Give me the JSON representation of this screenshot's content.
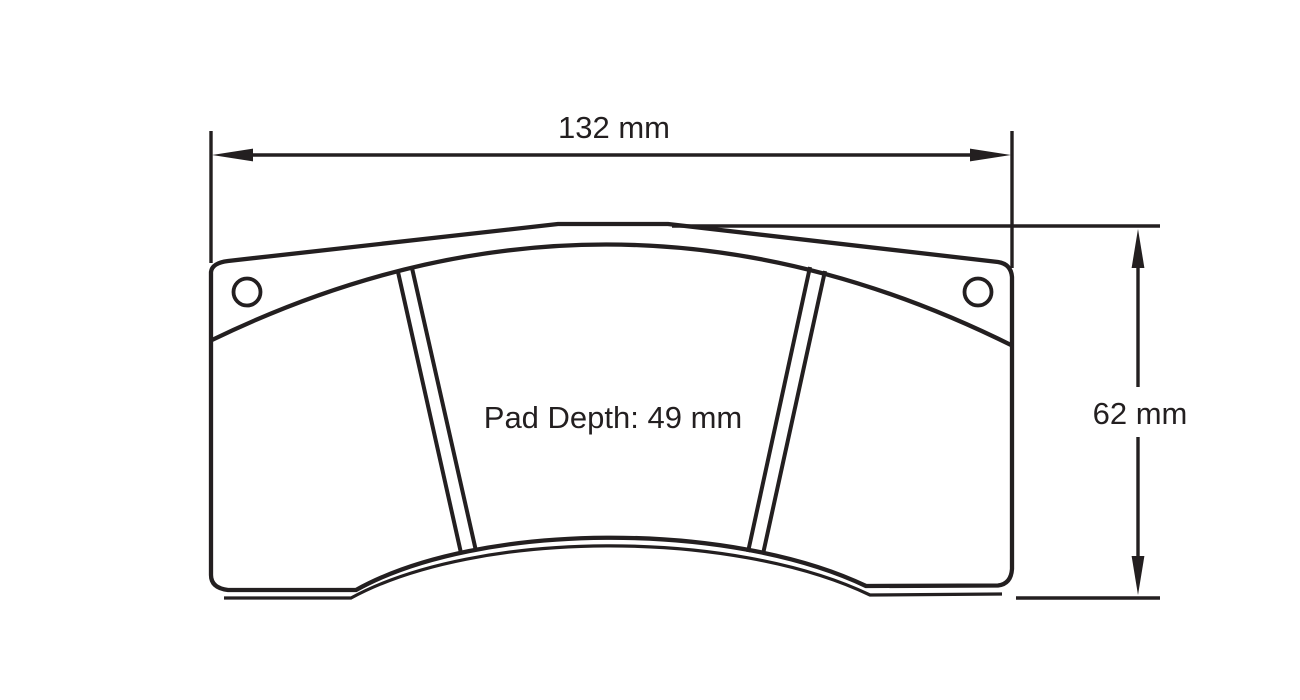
{
  "drawing": {
    "width_label": "132 mm",
    "height_label": "62 mm",
    "pad_depth_label": "Pad Depth: 49 mm",
    "line_color": "#231f20",
    "background_color": "#ffffff"
  }
}
